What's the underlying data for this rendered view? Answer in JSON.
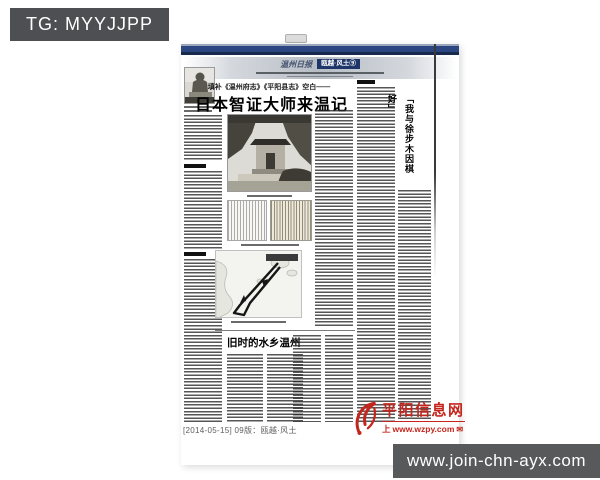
{
  "overlay": {
    "tag_label": "TG: MYYJJPP",
    "watermark_url": "www.join-chn-ayx.com"
  },
  "masthead": {
    "paper_name": "温州日报",
    "section_badge": "瓯越·风土⑨"
  },
  "main_article": {
    "kicker": "填补《温州府志》《平阳县志》空白——",
    "headline": "日本智证大师来温记"
  },
  "right_article": {
    "vertical_headline": "「我与徐步木因棋好」"
  },
  "bottom_article": {
    "headline": "旧时的水乡温州"
  },
  "footer": {
    "edition_line": "[2014-05-15] 09版：瓯越·风土"
  },
  "site_logo": {
    "name": "平阳信息网",
    "tagline_prefix": "上",
    "url": "www.wzpy.com"
  },
  "colors": {
    "navy_bar": "#2b4680",
    "badge_navy": "#1d3568",
    "tag_bg": "#4d4f52",
    "watermark_bg": "#58595b",
    "logo_red": "#c4261d"
  }
}
